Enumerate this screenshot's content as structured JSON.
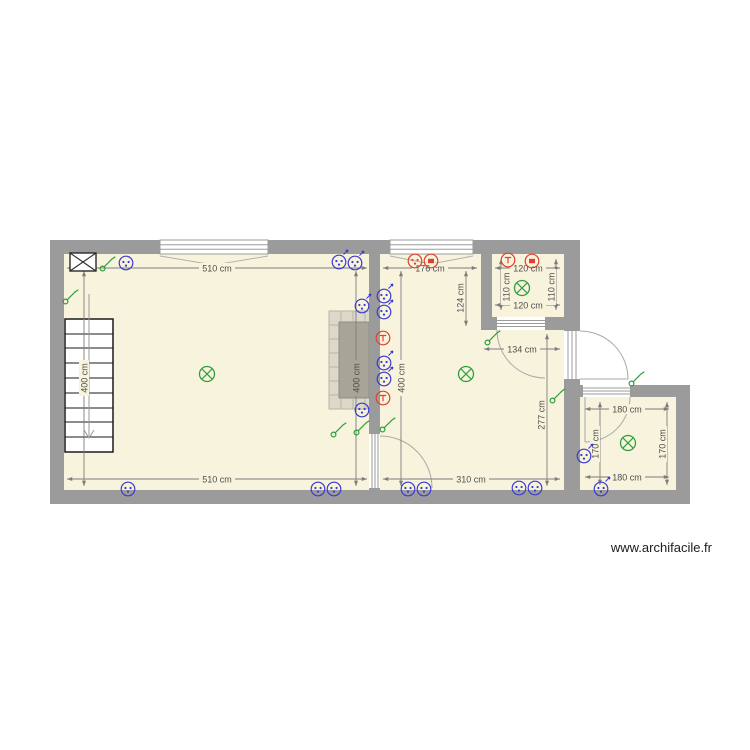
{
  "watermark": "www.archifacile.fr",
  "colors": {
    "wall": "#9b9b9b",
    "floor": "#f8f3dc",
    "socket": "#3a3ace",
    "switch": "#2f9e3e",
    "light": "#2f9e3e",
    "special": "#e0412e",
    "dimension": "#7d7d7d",
    "fireplace_frame": "#dcd9cb",
    "fireplace_core": "#a8a496"
  },
  "dimensions": {
    "room1": {
      "top": "510 cm",
      "bottom": "510 cm",
      "left": "400 cm",
      "right": "400 cm"
    },
    "room2": {
      "top": "176 cm",
      "left": "400 cm",
      "drop": "124 cm",
      "mid": "134 cm",
      "right": "277 cm",
      "bottom": "310 cm"
    },
    "small_room": {
      "top": "120 cm",
      "left": "110 cm",
      "right": "110 cm",
      "bottom": "120 cm"
    },
    "right_room": {
      "top": "180 cm",
      "left": "170 cm",
      "right": "170 cm",
      "bottom": "180 cm"
    }
  },
  "stairs": {
    "steps": 9
  },
  "symbols": [
    {
      "type": "vmc",
      "x": 83,
      "y": 262
    },
    {
      "type": "switch",
      "x": 107,
      "y": 264
    },
    {
      "type": "socket",
      "x": 126,
      "y": 263
    },
    {
      "type": "switch",
      "x": 70,
      "y": 297
    },
    {
      "type": "socket",
      "x": 339,
      "y": 262,
      "arrow": true
    },
    {
      "type": "socket",
      "x": 355,
      "y": 263,
      "arrow": true
    },
    {
      "type": "socket",
      "x": 362,
      "y": 306,
      "arrow": true
    },
    {
      "type": "light",
      "x": 207,
      "y": 374
    },
    {
      "type": "socket",
      "x": 362,
      "y": 410
    },
    {
      "type": "socket",
      "x": 128,
      "y": 489
    },
    {
      "type": "socket",
      "x": 318,
      "y": 489
    },
    {
      "type": "socket",
      "x": 334,
      "y": 489
    },
    {
      "type": "switch",
      "x": 338,
      "y": 430
    },
    {
      "type": "switch",
      "x": 361,
      "y": 428
    },
    {
      "type": "special",
      "glyph": "dots",
      "x": 415,
      "y": 261
    },
    {
      "type": "special",
      "glyph": "tv",
      "x": 431,
      "y": 261
    },
    {
      "type": "socket",
      "x": 384,
      "y": 296,
      "arrow": true
    },
    {
      "type": "socket",
      "x": 384,
      "y": 312,
      "arrow": true
    },
    {
      "type": "special",
      "glyph": "tel",
      "x": 383,
      "y": 338
    },
    {
      "type": "socket",
      "x": 384,
      "y": 363,
      "arrow": true
    },
    {
      "type": "socket",
      "x": 384,
      "y": 379,
      "arrow": true
    },
    {
      "type": "special",
      "glyph": "tel",
      "x": 383,
      "y": 398
    },
    {
      "type": "switch",
      "x": 387,
      "y": 425
    },
    {
      "type": "light",
      "x": 466,
      "y": 374
    },
    {
      "type": "switch",
      "x": 492,
      "y": 338
    },
    {
      "type": "switch",
      "x": 557,
      "y": 396
    },
    {
      "type": "socket",
      "x": 408,
      "y": 489
    },
    {
      "type": "socket",
      "x": 424,
      "y": 489
    },
    {
      "type": "socket",
      "x": 519,
      "y": 488
    },
    {
      "type": "socket",
      "x": 535,
      "y": 488
    },
    {
      "type": "special",
      "glyph": "tel",
      "x": 508,
      "y": 260
    },
    {
      "type": "special",
      "glyph": "tv",
      "x": 532,
      "y": 261
    },
    {
      "type": "light",
      "x": 522,
      "y": 288
    },
    {
      "type": "switch",
      "x": 636,
      "y": 379
    },
    {
      "type": "light",
      "x": 628,
      "y": 443
    },
    {
      "type": "socket",
      "x": 584,
      "y": 456,
      "arrow": true
    },
    {
      "type": "socket",
      "x": 601,
      "y": 489,
      "arrow": true
    }
  ]
}
